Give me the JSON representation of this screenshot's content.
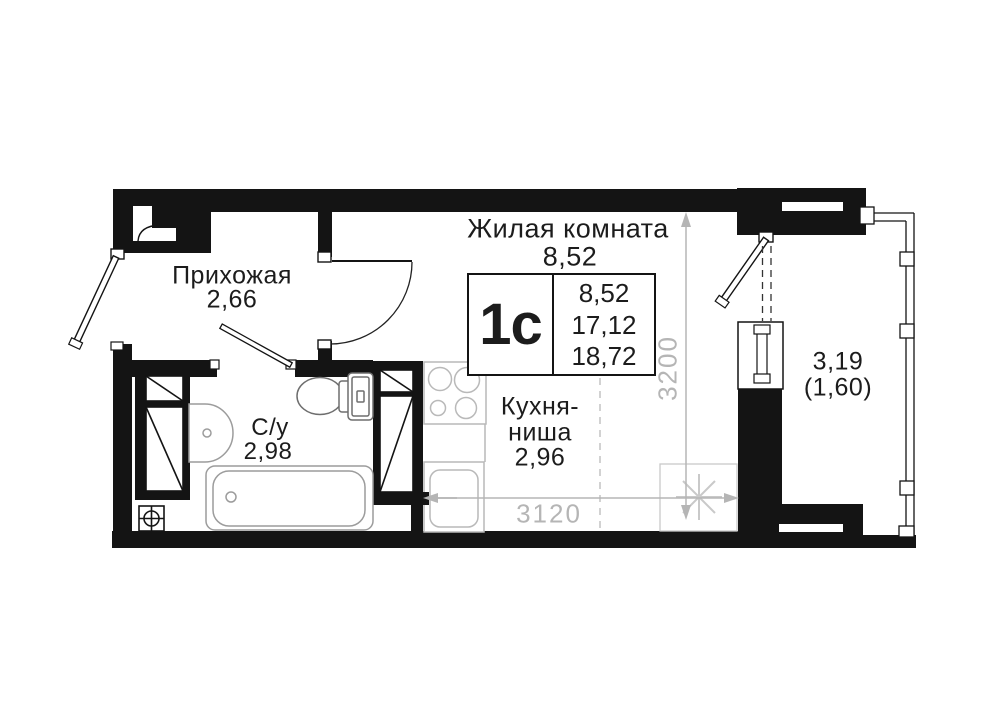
{
  "floor_plan": {
    "stamp": {
      "type": "1с",
      "living_area": "8,52",
      "area_without_balcony": "17,12",
      "total_area": "18,72"
    },
    "rooms": {
      "living": {
        "name": "Жилая комната",
        "area": "8,52"
      },
      "hallway": {
        "name": "Прихожая",
        "area": "2,66"
      },
      "bathroom": {
        "name": "С/у",
        "area": "2,98"
      },
      "kitchen": {
        "name_line_1": "Кухня-",
        "name_line_2": "ниша",
        "area": "2,96"
      },
      "balcony": {
        "area": "3,19",
        "area_coefficient": "(1,60)"
      }
    },
    "dimensions": {
      "horizontal_mm": "3120",
      "vertical_mm": "3200"
    },
    "colors": {
      "wall": "#141414",
      "dimension_gray": "#b5b5b5",
      "fixture_gray": "#9c9c9c"
    }
  }
}
